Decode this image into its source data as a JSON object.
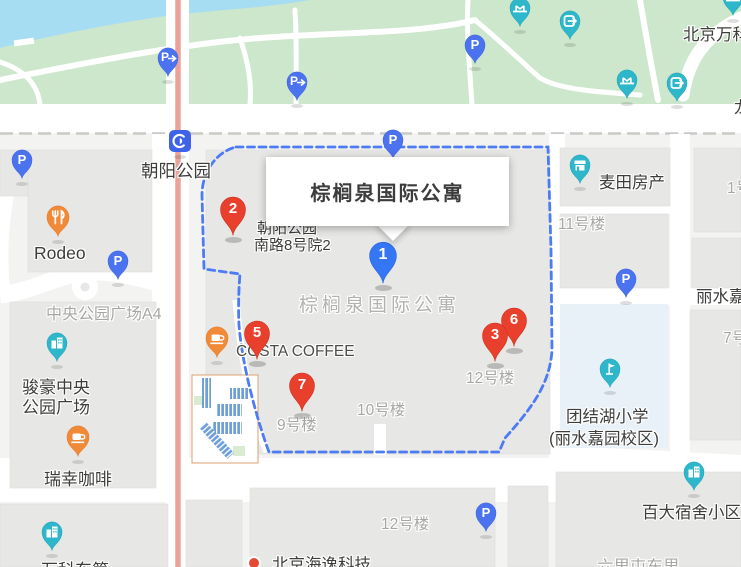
{
  "card": {
    "title": "棕榈泉国际公寓"
  },
  "markers": {
    "m1": {
      "number": "1",
      "color": "#3576f5"
    },
    "m2": {
      "number": "2",
      "color": "#e8402c"
    },
    "m3": {
      "number": "3",
      "color": "#e8402c"
    },
    "m5": {
      "number": "5",
      "color": "#e8402c"
    },
    "m6": {
      "number": "6",
      "color": "#e8402c"
    },
    "m7": {
      "number": "7",
      "color": "#e8402c"
    }
  },
  "glyphs": {
    "parking": "P"
  },
  "labels": {
    "chaoyang_park": "朝阳公园",
    "rodeo": "Rodeo",
    "central_park_plaza": "中央公园广场A4",
    "junhao_1": "骏豪中央",
    "junhao_2": "公园广场",
    "luckin_coffee": "瑞幸咖啡",
    "costa_coffee": "COSTA COFFEE",
    "address_1": "朝阳公园",
    "address_2": "南路8号院2",
    "compound": "棕榈泉国际公寓",
    "maitian_house": "麦田房产",
    "bldg_11": "11号楼",
    "bldg_1": "1号楼",
    "bldg_12": "12号楼",
    "bldg_10": "10号楼",
    "bldg_9": "9号楼",
    "bldg_12_south": "12号楼",
    "bldg_7": "7号楼",
    "lishui": "丽水嘉园",
    "school_1": "团结湖小学",
    "school_2": "(丽水嘉园校区)",
    "baida_dorm": "百大宿舍小区",
    "liulitun": "六里屯东里",
    "wanke_dongdi": "万科东第",
    "beijing_wanke": "北京万科",
    "long_rd": "龙",
    "beijing_hai": "北京海逸科技"
  },
  "colors": {
    "park_green": "#cde7cc",
    "water_blue": "#a7ddf3",
    "road_white": "#ffffff",
    "block_gray": "#e7e7e5",
    "school_block": "#e9f1f8",
    "main_road_salmon": "#eba29a",
    "boundary_dash_blue": "#4d7bf3",
    "parking_pin_blue": "#4b73ef",
    "poi_teal": "#2eb6ca",
    "poi_orange": "#f08a37",
    "marker_red": "#e8402c",
    "marker_blue": "#3576f5"
  }
}
